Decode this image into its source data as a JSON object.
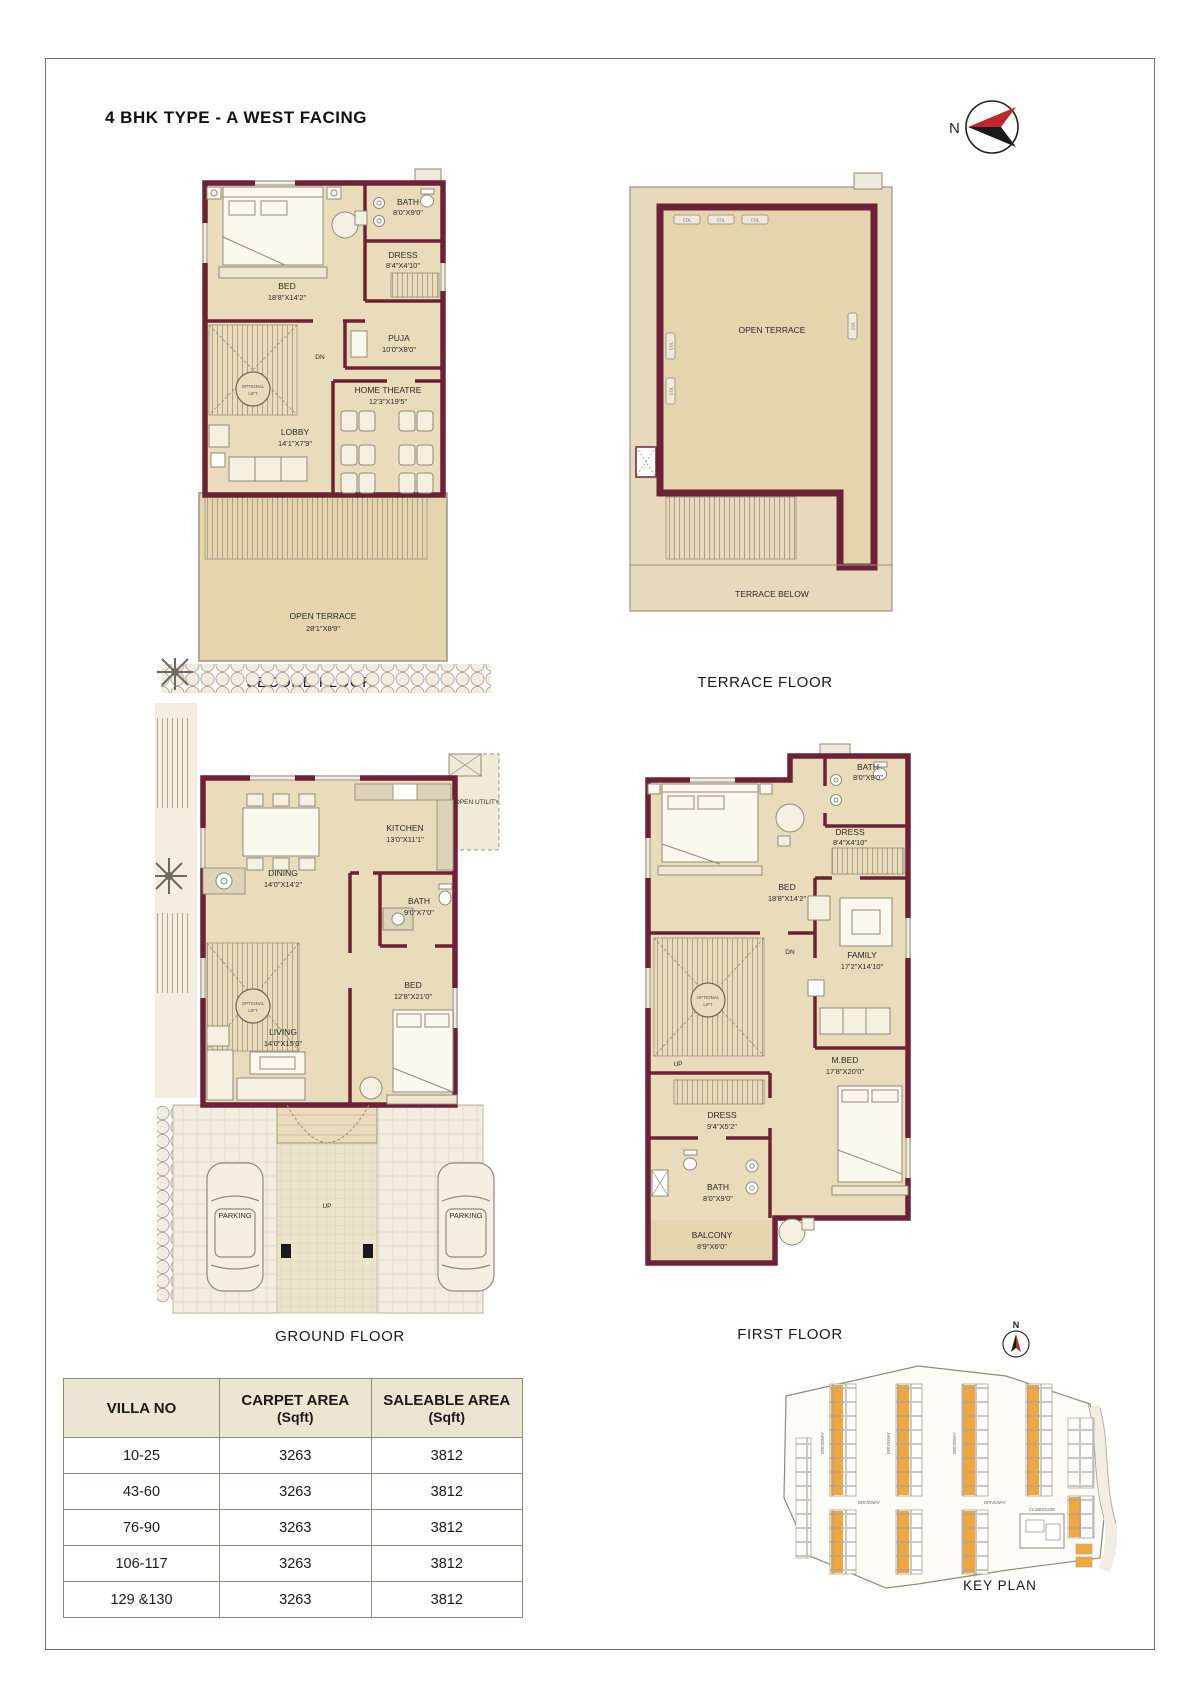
{
  "page": {
    "title": "4 BHK  TYPE - A WEST FACING"
  },
  "labels": {
    "north": "N",
    "optional": "OPTIONAL",
    "lift": "LIFT",
    "dn": "DN",
    "up": "UP",
    "col": "COL",
    "parking": "PARKING"
  },
  "plans": {
    "second_floor": {
      "caption": "SECOND FLOOR",
      "rooms": {
        "bed": {
          "name": "BED",
          "dims": "18'8\"X14'2\""
        },
        "bath": {
          "name": "BATH",
          "dims": "8'0\"X9'0\""
        },
        "dress": {
          "name": "DRESS",
          "dims": "8'4\"X4'10\""
        },
        "puja": {
          "name": "PUJA",
          "dims": "10'0\"X8'0\""
        },
        "lobby": {
          "name": "LOBBY",
          "dims": "14'1\"X7'9\""
        },
        "home_theatre": {
          "name": "HOME THEATRE",
          "dims": "12'3\"X19'5\""
        },
        "open_terrace": {
          "name": "OPEN TERRACE",
          "dims": "28'1\"X8'9\""
        }
      }
    },
    "terrace_floor": {
      "caption": "TERRACE FLOOR",
      "open_terrace_label": "OPEN TERRACE",
      "terrace_below_label": "TERRACE BELOW"
    },
    "ground_floor": {
      "caption": "GROUND FLOOR",
      "rooms": {
        "dining": {
          "name": "DINING",
          "dims": "14'0\"X14'2\""
        },
        "kitchen": {
          "name": "KITCHEN",
          "dims": "13'0\"X11'1\""
        },
        "open_utility": {
          "name": "OPEN UTILITY"
        },
        "bath": {
          "name": "BATH",
          "dims": "9'0\"X7'0\""
        },
        "bed": {
          "name": "BED",
          "dims": "12'8\"X21'0\""
        },
        "living": {
          "name": "LIVING",
          "dims": "14'0\"X15'0\""
        }
      }
    },
    "first_floor": {
      "caption": "FIRST FLOOR",
      "rooms": {
        "bed": {
          "name": "BED",
          "dims": "18'8\"X14'2\""
        },
        "bath_top": {
          "name": "BATH",
          "dims": "8'0\"X9'0\""
        },
        "dress_top": {
          "name": "DRESS",
          "dims": "8'4\"X4'10\""
        },
        "family": {
          "name": "FAMILY",
          "dims": "17'2\"X14'10\""
        },
        "dress_mid": {
          "name": "DRESS",
          "dims": "9'4\"X5'2\""
        },
        "m_bed": {
          "name": "M.BED",
          "dims": "17'8\"X20'0\""
        },
        "bath_low": {
          "name": "BATH",
          "dims": "8'0\"X9'0\""
        },
        "balcony": {
          "name": "BALCONY",
          "dims": "8'9\"X6'0\""
        }
      }
    }
  },
  "area_table": {
    "columns": [
      {
        "title": "VILLA NO",
        "unit": ""
      },
      {
        "title": "CARPET AREA",
        "unit": "(Sqft)"
      },
      {
        "title": "SALEABLE AREA",
        "unit": "(Sqft)"
      }
    ],
    "rows": [
      {
        "villa_no": "10-25",
        "carpet_area": "3263",
        "saleable_area": "3812"
      },
      {
        "villa_no": "43-60",
        "carpet_area": "3263",
        "saleable_area": "3812"
      },
      {
        "villa_no": "76-90",
        "carpet_area": "3263",
        "saleable_area": "3812"
      },
      {
        "villa_no": "106-117",
        "carpet_area": "3263",
        "saleable_area": "3812"
      },
      {
        "villa_no": "129 &130",
        "carpet_area": "3263",
        "saleable_area": "3812"
      }
    ]
  },
  "key_plan": {
    "caption": "KEY PLAN",
    "clubhouse_label": "CLUBHOUSE",
    "driveway_label": "DRIVEWAY",
    "north_label": "N",
    "highlight_color": "#f0a73e"
  },
  "colors": {
    "wall": "#6d2136",
    "floor": "#e9dcba",
    "terrace": "#e4d5ae",
    "table_header_bg": "#ebe5d2"
  }
}
